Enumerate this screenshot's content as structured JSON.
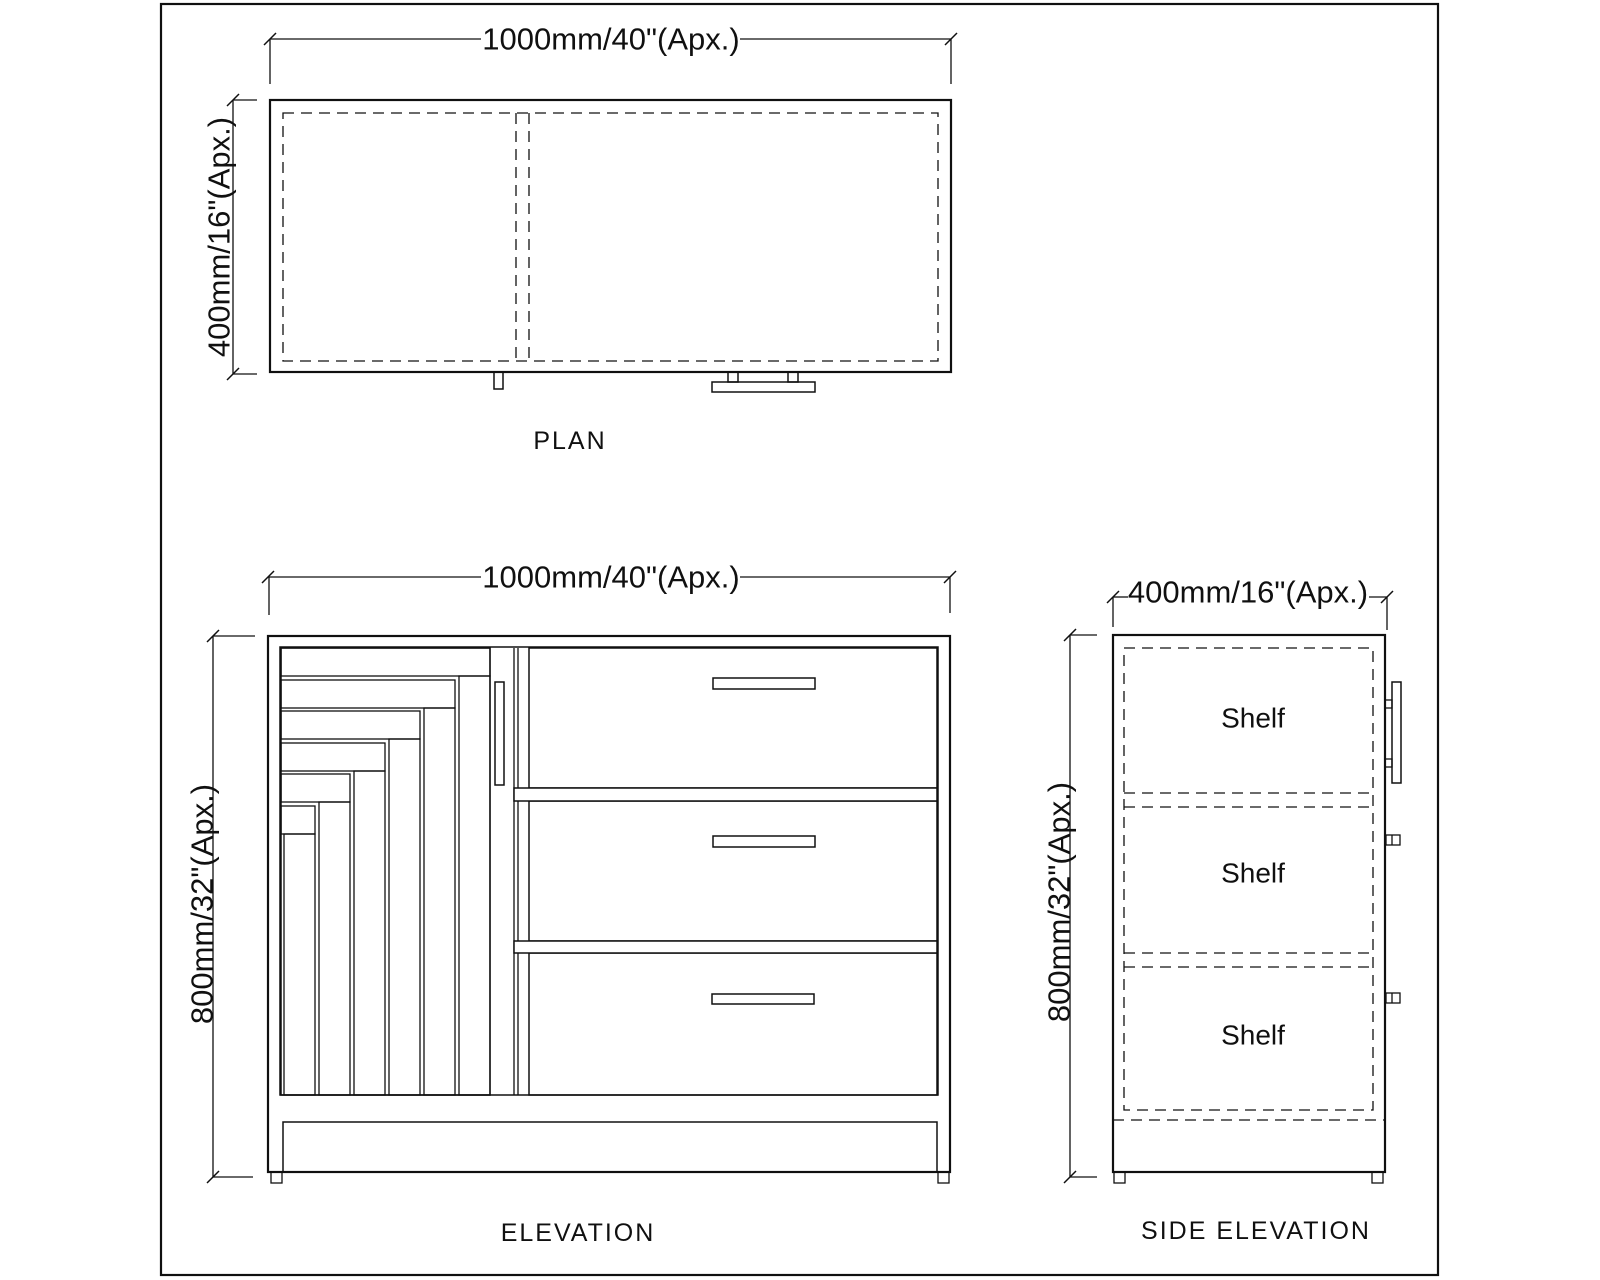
{
  "sheet": {
    "views": {
      "plan": {
        "label": "PLAN",
        "width_dim": "1000mm/40\"(Apx.)",
        "depth_dim": "400mm/16\"(Apx.)"
      },
      "elevation": {
        "label": "ELEVATION",
        "width_dim": "1000mm/40\"(Apx.)",
        "height_dim": "800mm/32\"(Apx.)"
      },
      "side_elevation": {
        "label": "SIDE ELEVATION",
        "width_dim": "400mm/16\"(Apx.)",
        "height_dim": "800mm/32\"(Apx.)",
        "shelves": [
          "Shelf",
          "Shelf",
          "Shelf"
        ]
      }
    },
    "colors": {
      "line": "#101010",
      "background": "#ffffff"
    }
  }
}
